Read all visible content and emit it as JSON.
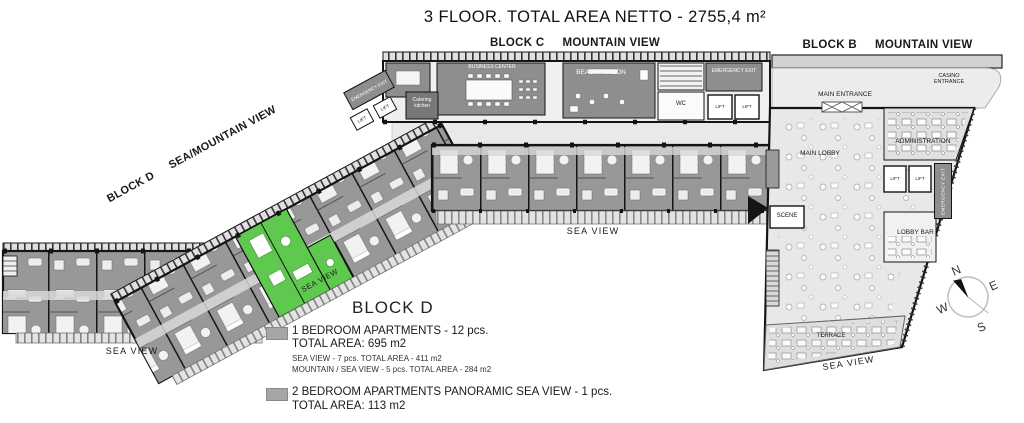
{
  "title": "3 FLOOR. TOTAL AREA NETTO - 2755,4 m²",
  "blocks": {
    "c": {
      "name": "BLOCK C",
      "view": "MOUNTAIN VIEW"
    },
    "b": {
      "name": "BLOCK B",
      "view": "MOUNTAIN VIEW"
    },
    "d": {
      "name": "BLOCK D",
      "view": "SEA/MOUNTAIN VIEW"
    }
  },
  "rooms": {
    "business_center": "BUSINESS CENTER",
    "beauty_salon": "BEAUTY SALON",
    "catering_kitchen": "Catering kitchen",
    "wc": "WC",
    "lift": "LIFT",
    "emergency_exit": "EMERGENCY EXIT",
    "main_entrance": "MAIN ENTRANCE",
    "casino_entrance": "CASINO ENTRANCE",
    "main_lobby": "MAIN LOBBY",
    "administration": "ADMINISTRATION",
    "lobby_bar": "LOBBY BAR",
    "scene": "SCENE",
    "terrace": "TERRACE",
    "sea_view": "SEA VIEW"
  },
  "legend": {
    "heading": "BLOCK D",
    "items": [
      {
        "label": "1 BEDROOM APARTMENTS - 12 pcs.",
        "total": "TOTAL AREA: 695 m2",
        "details": [
          "SEA VIEW - 7 pcs. TOTAL AREA - 411 m2",
          "MOUNTAIN / SEA VIEW - 5 pcs. TOTAL AREA - 284 m2"
        ]
      },
      {
        "label": "2 BEDROOM APARTMENTS PANORAMIC SEA VIEW - 1 pcs.",
        "total": "TOTAL AREA: 113 m2",
        "details": []
      }
    ]
  },
  "compass": {
    "n": "N",
    "e": "E",
    "s": "S",
    "w": "W"
  },
  "colors": {
    "apartment_gray": "#989898",
    "dark_room": "#8e8e8e",
    "highlight_green": "#5ec94e",
    "legend_swatch": "#a6a6a6",
    "corridor": "#e9e9e9",
    "wall": "#141414"
  }
}
